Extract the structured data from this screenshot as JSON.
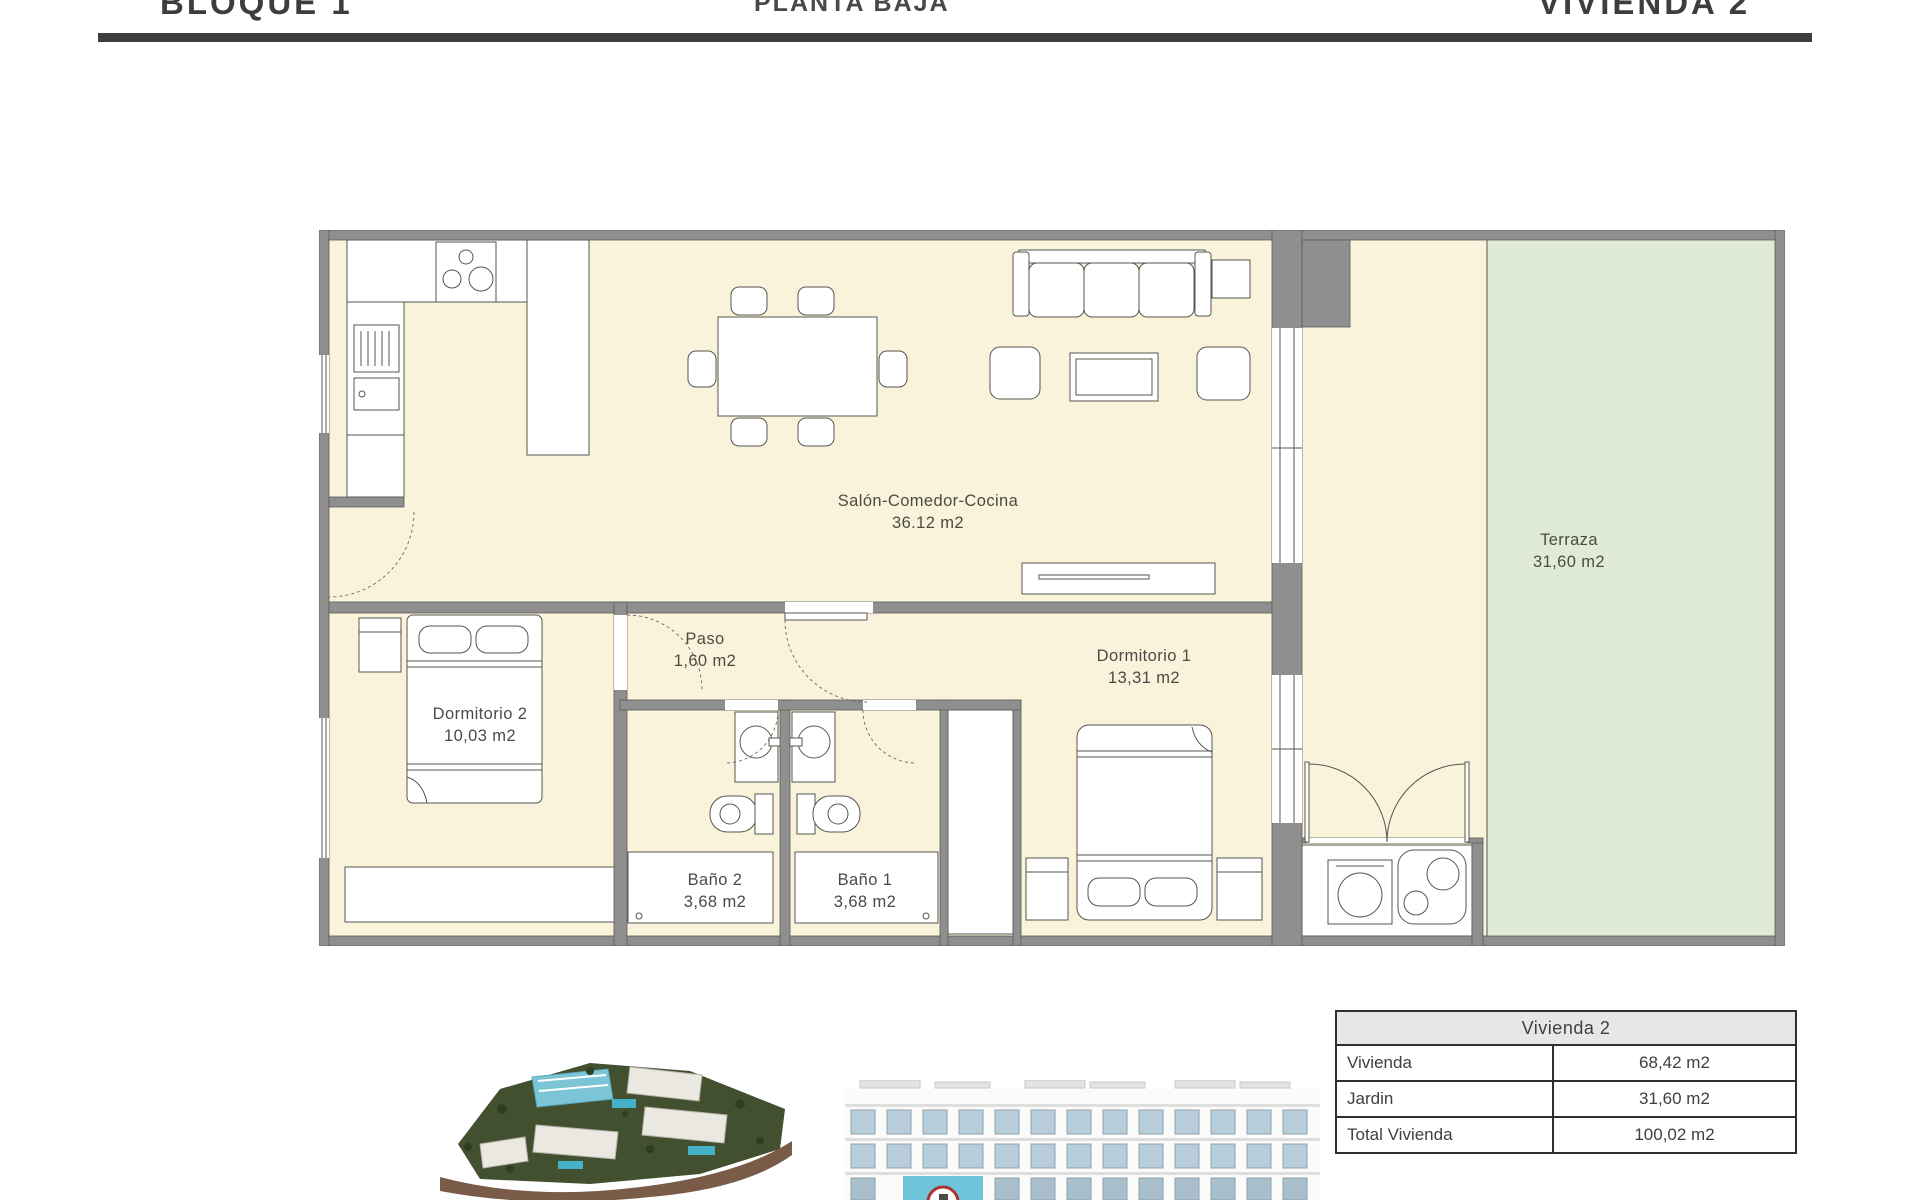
{
  "header": {
    "left": "BLOQUE 1",
    "center": "PLANTA BAJA",
    "right": "VIVIENDA 2"
  },
  "plan": {
    "rooms": {
      "salon": {
        "name": "Salón-Comedor-Cocina",
        "area": "36.12 m2"
      },
      "paso": {
        "name": "Paso",
        "area": "1,60 m2"
      },
      "dormitorio2": {
        "name": "Dormitorio 2",
        "area": "10,03 m2"
      },
      "dormitorio1": {
        "name": "Dormitorio 1",
        "area": "13,31 m2"
      },
      "bano2": {
        "name": "Baño 2",
        "area": "3,68 m2"
      },
      "bano1": {
        "name": "Baño 1",
        "area": "3,68 m2"
      },
      "terraza": {
        "name": "Terraza",
        "area": "31,60 m2"
      }
    },
    "colors": {
      "wall": "#8f8f8f",
      "floor": "#faf3dc",
      "terrace": "#e0ebd5",
      "highlight_unit": "#6fc4da",
      "pin_red": "#a93434"
    }
  },
  "summary_table": {
    "title": "Vivienda 2",
    "rows": [
      {
        "label": "Vivienda",
        "value": "68,42 m2"
      },
      {
        "label": "Jardin",
        "value": "31,60 m2"
      },
      {
        "label": "Total Vivienda",
        "value": "100,02 m2"
      }
    ]
  }
}
